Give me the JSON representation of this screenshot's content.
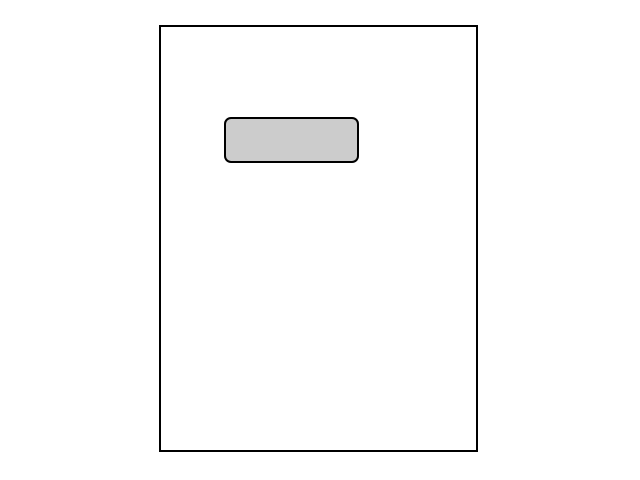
{
  "canvas": {
    "background_color": "#ffffff"
  },
  "page_outline": {
    "description": "empty portrait page outline",
    "fill_color": "#ffffff",
    "border_color": "#000000"
  },
  "gray_box": {
    "description": "gray rounded rectangle placeholder near top of page",
    "fill_color": "#cccccc",
    "border_color": "#000000"
  }
}
